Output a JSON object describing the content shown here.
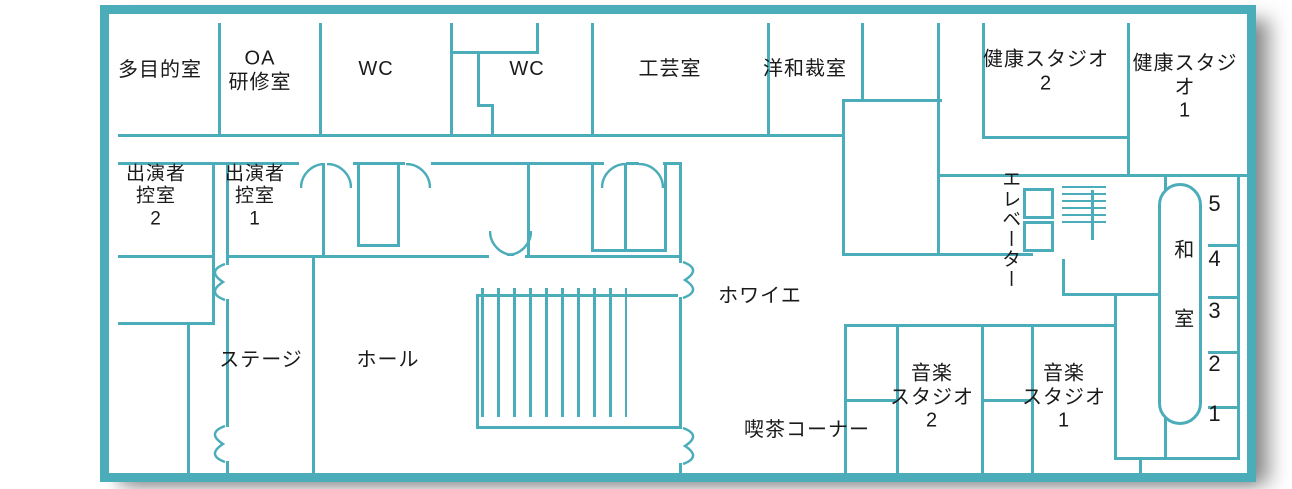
{
  "floorplan": {
    "rooms": {
      "multipurpose": {
        "label": "多目的室"
      },
      "oa_training": {
        "label": "OA\n研修室"
      },
      "wc1": {
        "label": "WC"
      },
      "wc2": {
        "label": "WC"
      },
      "craft": {
        "label": "工芸室"
      },
      "sewing": {
        "label": "洋和裁室"
      },
      "health_studio2": {
        "label": "健康スタジオ\n2"
      },
      "health_studio1": {
        "label": "健康スタジオ\n1"
      },
      "performer_room2": {
        "label": "出演者\n控室\n2"
      },
      "performer_room1": {
        "label": "出演者\n控室\n1"
      },
      "stage": {
        "label": "ステージ"
      },
      "hall": {
        "label": "ホール"
      },
      "foyer": {
        "label": "ホワイエ"
      },
      "elevator": {
        "label": "エレベーター"
      },
      "cafe": {
        "label": "喫茶コーナー"
      },
      "music_studio2": {
        "label": "音楽\nスタジオ\n2"
      },
      "music_studio1": {
        "label": "音楽\nスタジオ\n1"
      },
      "japanese_room": {
        "label": "和室",
        "numbers": [
          "5",
          "4",
          "3",
          "2",
          "1"
        ]
      }
    },
    "colors": {
      "wall": "#4badba",
      "text": "#1a1a1a"
    }
  }
}
